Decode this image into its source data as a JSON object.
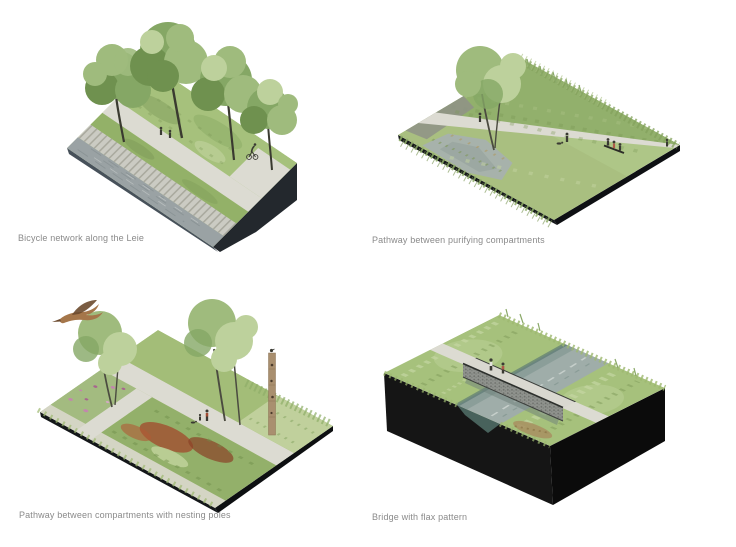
{
  "page": {
    "background": "#ffffff"
  },
  "palette": {
    "paper": "#ffffff",
    "caption_text": "#8a8a8a",
    "tree_dark": "#6f914f",
    "tree_mid": "#85a765",
    "tree_light": "#9fbb7d",
    "tree_pale": "#bdd19c",
    "grass": "#a6c17c",
    "grass_light": "#c3d4a0",
    "grass_dark": "#7d9a58",
    "path": "#dcdbd2",
    "steps": "#cbcbc3",
    "water_gray": "#9aa2a4",
    "water_river": "#9fada9",
    "water_teal": "#48625c",
    "base_slate": "#47515a",
    "base_dark": "#23282d",
    "base_black": "#121212",
    "pole_wood": "#a98f6f",
    "bird_brown": "#a5764a",
    "bird_wing": "#6b4a2e",
    "flower_pink": "#c287ad",
    "reed_red": "#a14f30",
    "reed_tan": "#a98c5f",
    "figure_dark": "#3a3a33",
    "accent_red": "#b05a4a",
    "gabion_gray": "#90938e"
  },
  "figures": [
    {
      "id": "bicycle-network",
      "caption": "Bicycle network along the Leie",
      "depicts": "isometric riverbank block: river, stepped embankment, grass verge, cycle path with pedestrians and a cyclist, four trees"
    },
    {
      "id": "purifying-compartments",
      "caption": "Pathway between purifying compartments",
      "depicts": "isometric wetland plate: pond, reed compartments, diagonal footpath, bench with seated people, walker with dog, tree, tall grass mound"
    },
    {
      "id": "nesting-poles",
      "caption": "Pathway between compartments with nesting poles",
      "depicts": "isometric wetland plate: flowering compartments, footpath grid, walkers with dog, two tree groups, wooden nesting pole, flying bird"
    },
    {
      "id": "flax-bridge",
      "caption": "Bridge with flax pattern",
      "depicts": "isometric block cut by a river channel, grassy reed banks, gabion flax-pattern footbridge with two people"
    }
  ]
}
